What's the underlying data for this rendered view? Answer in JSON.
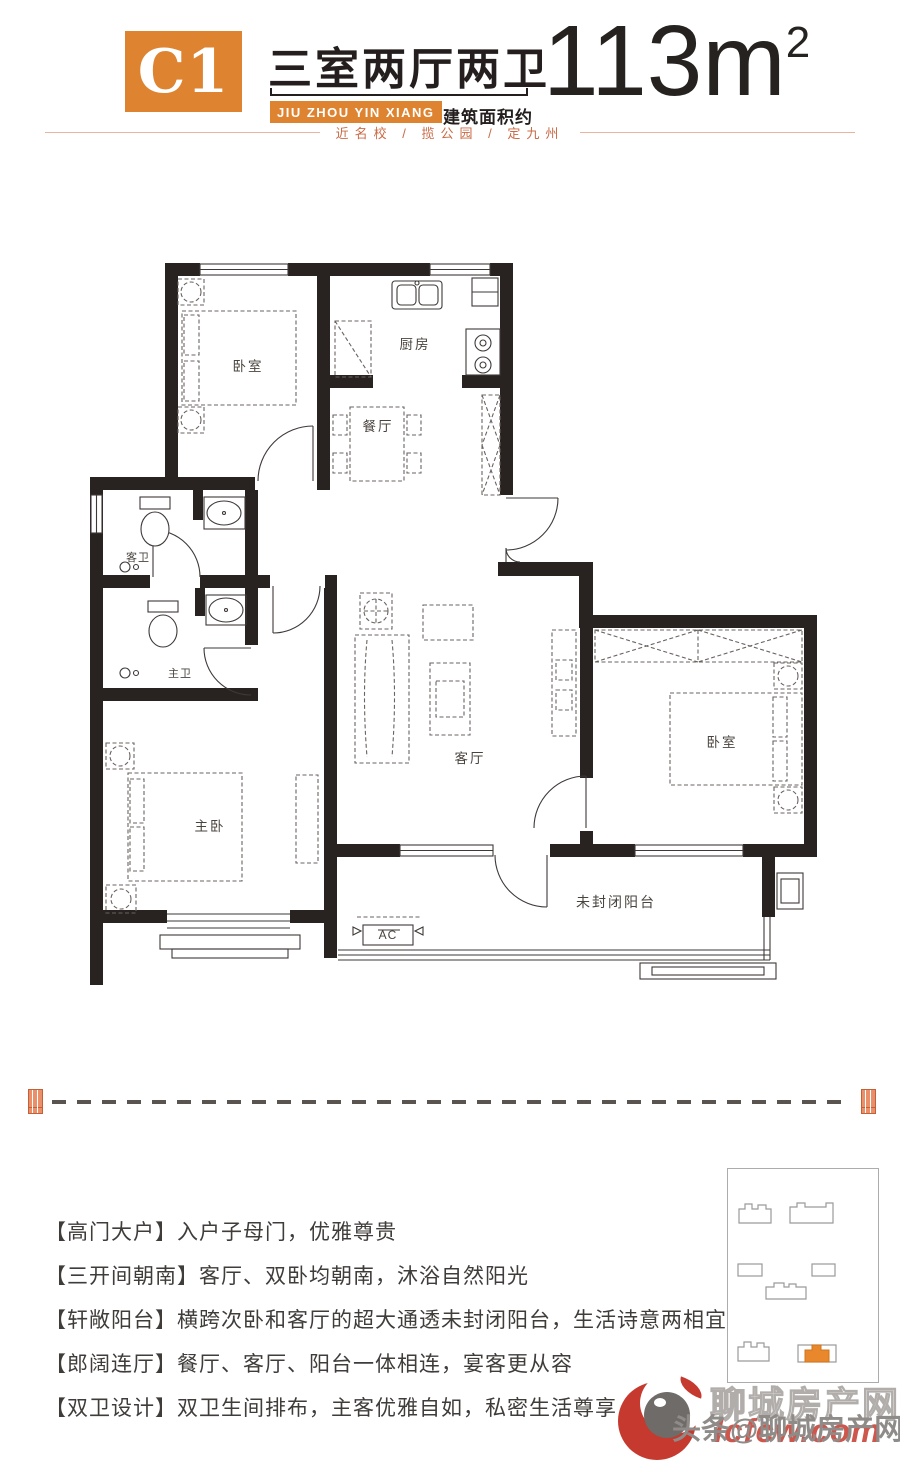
{
  "header": {
    "unit_code": "C1",
    "unit_title": "三室两厅两卫",
    "brand_en": "JIU ZHOU YIN XIANG",
    "area_label": "建筑面积约",
    "area_value": "113m",
    "area_sup": "2",
    "tagline": "近名校 / 揽公园 / 定九州"
  },
  "floorplan": {
    "labels": {
      "bedroom1": "卧室",
      "kitchen": "厨房",
      "dining": "餐厅",
      "guest_bath": "客卫",
      "master_bath": "主卫",
      "master_bedroom": "主卧",
      "living": "客厅",
      "bedroom2": "卧室",
      "balcony": "未封闭阳台",
      "ac_unit": "AC"
    }
  },
  "features": {
    "items": [
      "【高门大户】入户子母门，优雅尊贵",
      "【三开间朝南】客厅、双卧均朝南，沐浴自然阳光",
      "【轩敞阳台】横跨次卧和客厅的超大通透未封闭阳台，生活诗意两相宜",
      "【郎阔连厅】餐厅、客厅、阳台一体相连，宴客更从容",
      "【双卫设计】双卫生间排布，主客优雅自如，私密生活尊享"
    ]
  },
  "colors": {
    "accent": "#DE8430",
    "tagline": "#C96B47",
    "sitemap_highlight": "#E8872B",
    "watermark_red": "#C5392E"
  },
  "watermark": {
    "outline_text": "聊城房产网",
    "main_text": "头条@聊城房产网",
    "site_text": "lcfcw.com"
  }
}
